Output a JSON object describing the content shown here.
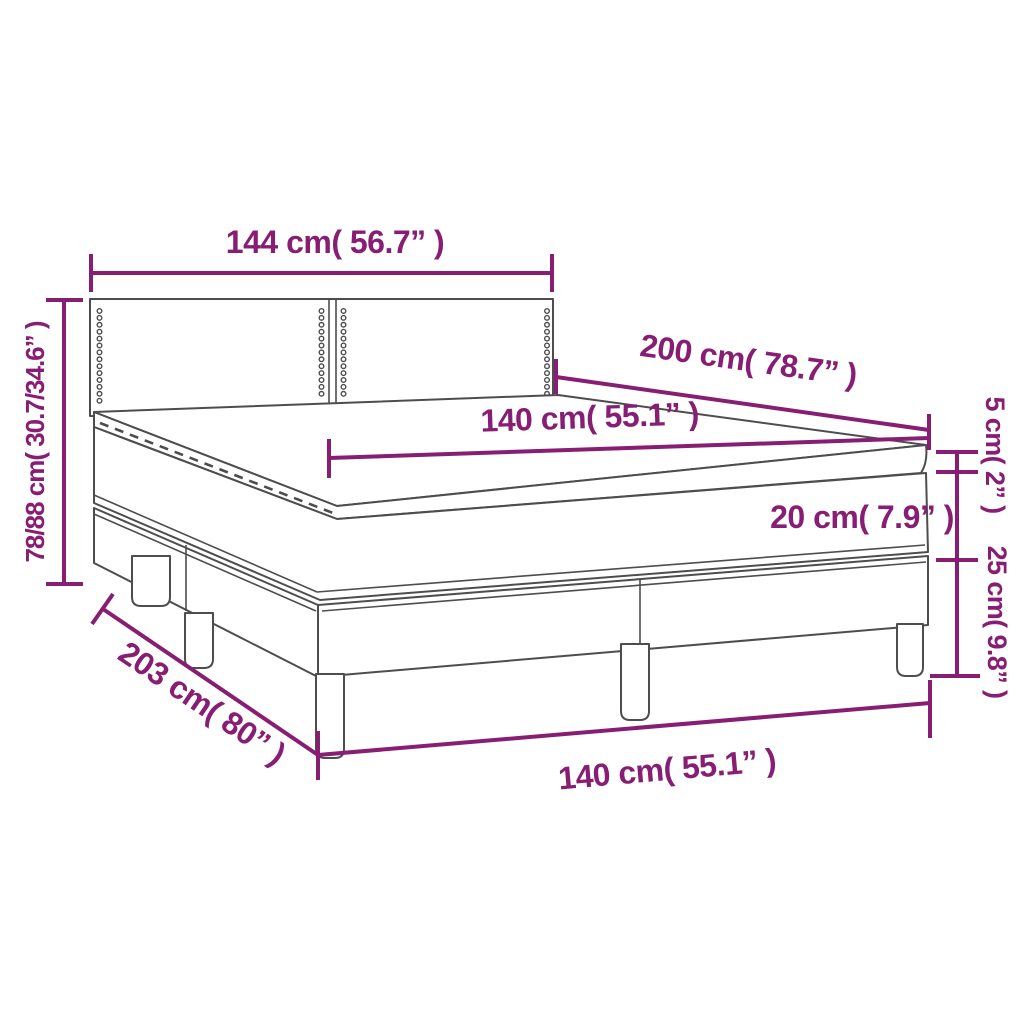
{
  "colors": {
    "dimension": "#871E73",
    "outline": "#4D4D4D",
    "background": "#FFFFFF"
  },
  "labels": {
    "headboard_width": "144 cm( 56.7” )",
    "bed_height": "78/88 cm( 30.7/34.6” )",
    "bed_length": "200 cm( 78.7” )",
    "mattress_width": "140 cm( 55.1” )",
    "topper_thickness": "5 cm( 2” )",
    "mattress_thickness": "20 cm( 7.9” )",
    "base_height": "25 cm( 9.8” )",
    "base_width": "140 cm( 55.1” )",
    "base_length": "203 cm( 80” )"
  }
}
